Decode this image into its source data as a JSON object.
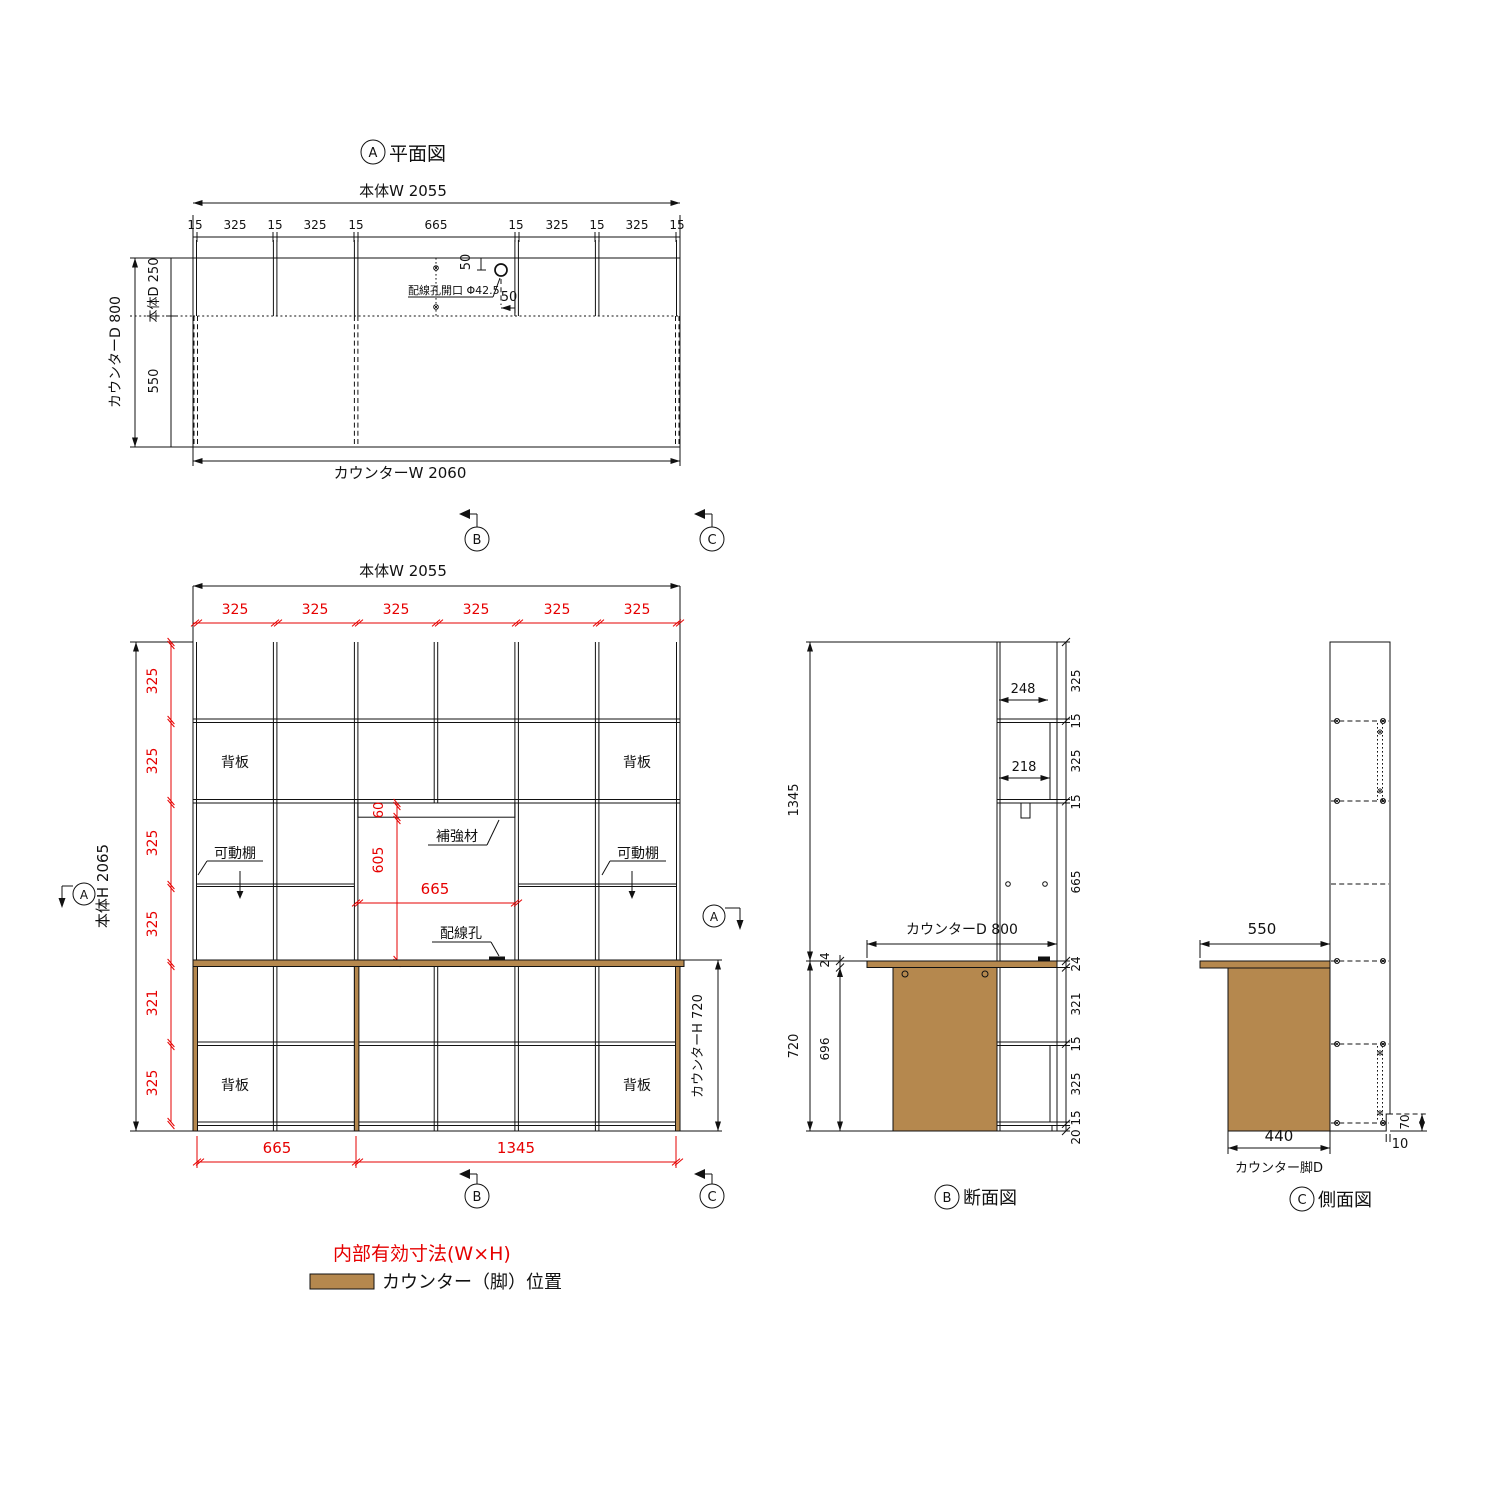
{
  "colors": {
    "red": "#e60000",
    "brown": "#b5884e",
    "line": "#111111"
  },
  "markers": {
    "a": "A",
    "b": "B",
    "c": "C"
  },
  "plan": {
    "title": "平面図",
    "body_w_label": "本体W 2055",
    "chain": [
      "15",
      "325",
      "15",
      "325",
      "15",
      "665",
      "15",
      "325",
      "15",
      "325",
      "15"
    ],
    "counter_w_label": "カウンターW 2060",
    "counter_d_label": "カウンターD 800",
    "body_d_label": "本体D 250",
    "front_depth": "550",
    "hole_label": "配線孔開口 Φ42.5",
    "hole_offset_top": "50",
    "hole_offset_side": "50"
  },
  "elevation": {
    "body_w_label": "本体W 2055",
    "col_dims": [
      "325",
      "325",
      "325",
      "325",
      "325",
      "325"
    ],
    "row_dims": [
      "325",
      "325",
      "325",
      "325",
      "321",
      "325"
    ],
    "body_h_label": "本体H 2065",
    "counter_h_label": "カウンターH 720",
    "back_panel": "背板",
    "movable_shelf": "可動棚",
    "reinforcement": "補強材",
    "wiring_hole": "配線孔",
    "reinforcement_h": "60",
    "opening_h": "605",
    "opening_w": "665",
    "bottom_left": "665",
    "bottom_right": "1345"
  },
  "section_b": {
    "title": "断面図",
    "upper_total": "1345",
    "counter_d_label": "カウンターD 800",
    "depth_top": "248",
    "depth_shelf": "218",
    "chain_top": [
      "325",
      "15",
      "325",
      "15",
      "665"
    ],
    "chain_bottom": [
      "24",
      "321",
      "15",
      "325",
      "15",
      "20"
    ],
    "counter_t": "24",
    "leg_h": "696",
    "counter_h": "720"
  },
  "side_c": {
    "title": "側面図",
    "counter_overhang": "550",
    "leg_d": "440",
    "leg_d_label": "カウンター脚D",
    "notch_h": "70",
    "notch_d": "10"
  },
  "legend": {
    "inner_dim_note": "内部有効寸法(W×H)",
    "counter_pos_note": "カウンター（脚）位置"
  }
}
